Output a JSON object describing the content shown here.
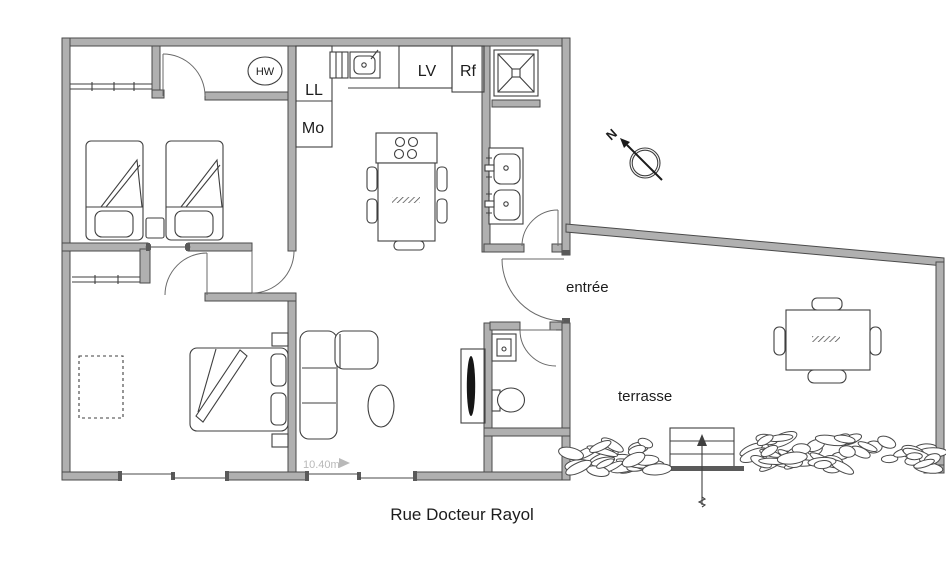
{
  "plan": {
    "street_label": "Rue Docteur Rayol",
    "dimension_label": "10.40m",
    "compass": {
      "north": "N"
    },
    "labels": {
      "entrance": "entrée",
      "terrace": "terrasse"
    },
    "appliances": {
      "water_heater": "HW",
      "washing_machine": "LL",
      "oven": "Mo",
      "dishwasher": "LV",
      "refrigerator": "Rf"
    },
    "colors": {
      "wall_fill": "#b0b0b0",
      "wall_stroke": "#4a4a4a",
      "furniture_line": "#3f3f3f",
      "dim_text": "#b9b9b9",
      "text": "#1c1c1c",
      "background": "#ffffff"
    }
  }
}
